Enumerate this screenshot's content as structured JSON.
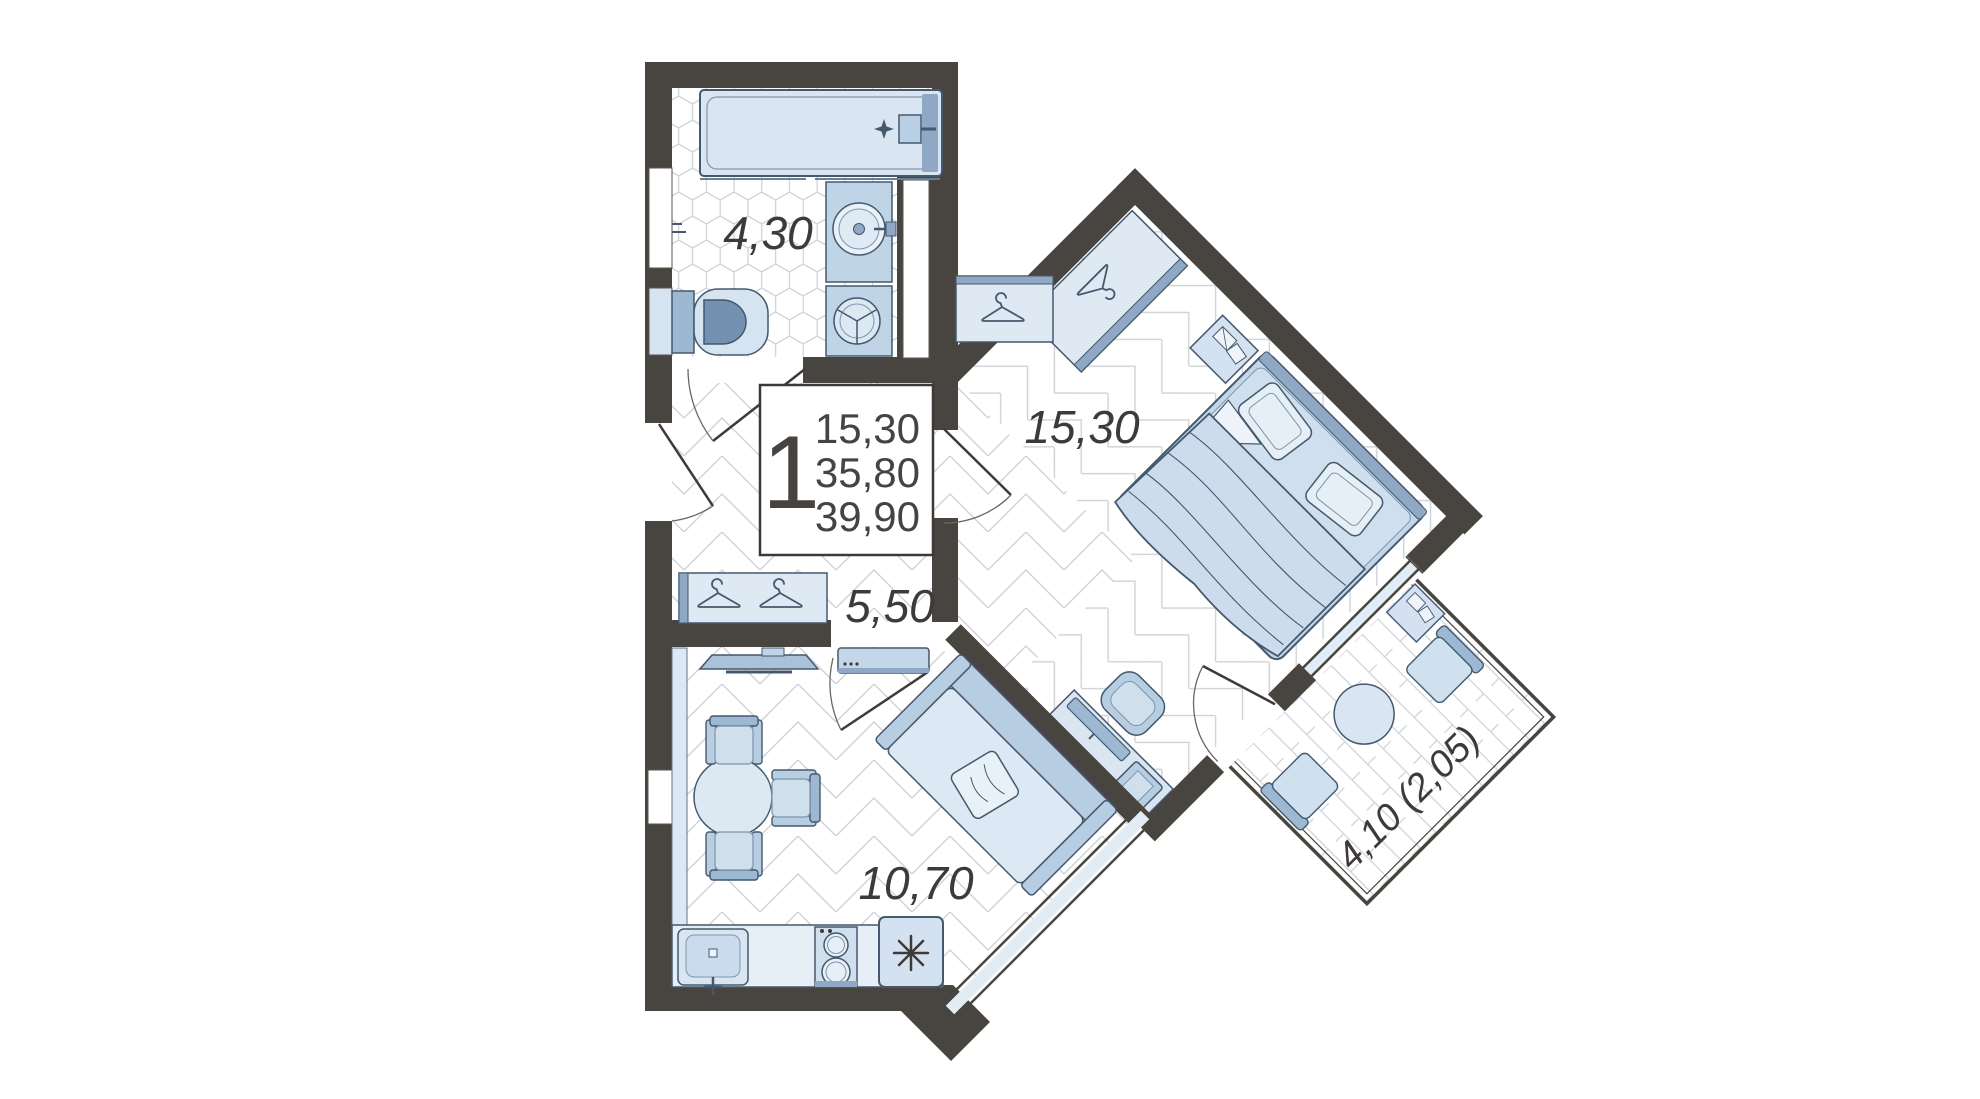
{
  "floor_plan": {
    "info_box": {
      "room_count": "1",
      "living_area": "15,30",
      "apartment_area": "35,80",
      "total_area": "39,90"
    },
    "rooms": {
      "bathroom": {
        "area_label": "4,30"
      },
      "hallway": {
        "area_label": "5,50"
      },
      "bedroom": {
        "area_label": "15,30"
      },
      "kitchen_living_room": {
        "area_label": "10,70"
      },
      "balcony": {
        "area_label": "4,10 (2,05)"
      }
    },
    "colors": {
      "wall": "#48443f",
      "furniture_light": "#dce9f4",
      "furniture_medium": "#b7cde1",
      "furniture_accent": "#8fa9c4",
      "outline": "#44586e",
      "text": "#3e3a38",
      "floor_line": "#ced3d9"
    }
  }
}
